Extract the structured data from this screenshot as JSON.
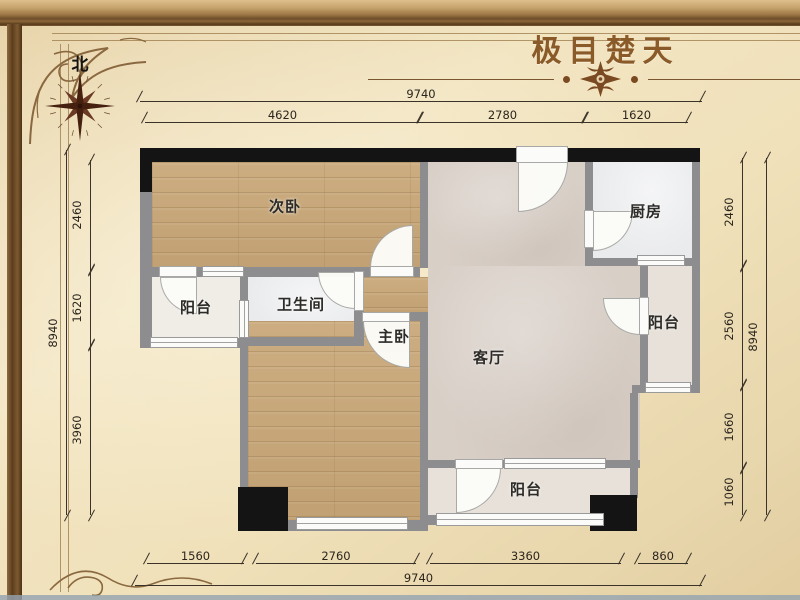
{
  "title": "极目楚天",
  "compass": {
    "label": "北"
  },
  "rooms": {
    "bedroom2": "次卧",
    "balcony_left": "阳台",
    "bathroom": "卫生间",
    "master_bedroom": "主卧",
    "living_room": "客厅",
    "kitchen": "厨房",
    "balcony_right": "阳台",
    "balcony_bottom": "阳台"
  },
  "dims": {
    "top": {
      "total": "9740",
      "segments": [
        "4620",
        "2780",
        "1620"
      ]
    },
    "bottom": {
      "total": "9740",
      "segments": [
        "1560",
        "2760",
        "3360",
        "860"
      ]
    },
    "left": {
      "total": "8940",
      "segments": [
        "2460",
        "1620",
        "3960"
      ]
    },
    "right": {
      "total": "8940",
      "segments": [
        "2460",
        "2560",
        "1660",
        "1060"
      ]
    }
  },
  "colors": {
    "accent_brown": "#8a5a28",
    "wall_gray": "#8d8d8f",
    "wall_black": "#141414",
    "wood": "#c9aa7e",
    "carpet": "#d8cfc7",
    "tile": "#eaebed",
    "parchment": "#f0e2c0"
  }
}
